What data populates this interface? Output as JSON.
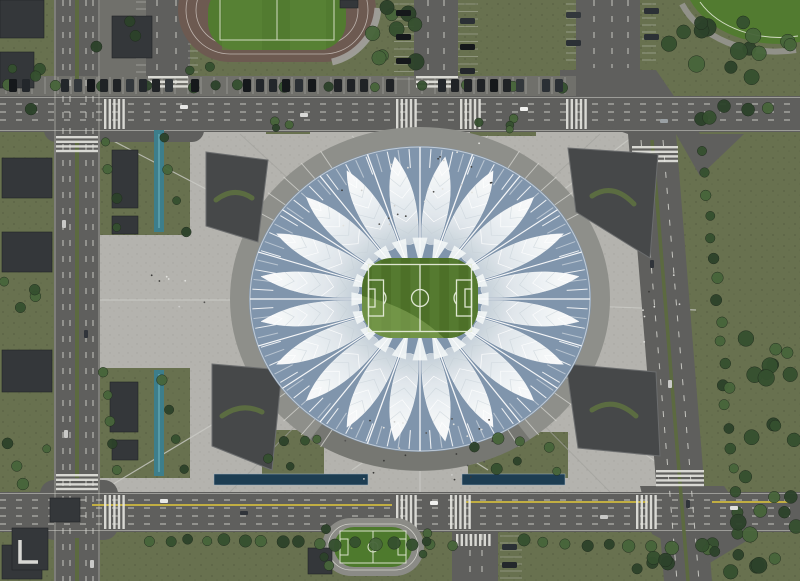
{
  "scene": {
    "kind": "aerial-architectural-rendering",
    "subject": "lotus-flower stadium with central football pitch, surrounding plaza, perimeter roads, sports fields, canals and tree-lined streets"
  },
  "palette": {
    "grass": "#68714f",
    "grass_speck_a": "#49513a",
    "grass_speck_b": "#566043",
    "tree_a": "#35502f",
    "tree_b": "#47653a",
    "tree_c": "#2c422a",
    "plaza": "#b4b3ae",
    "plaza_speck_a": "#97968f",
    "plaza_speck_b": "#a39f97",
    "plaza_line_light": "#cbcbc6",
    "plaza_line_dark": "#a2a29d",
    "asphalt": "#5f5f5d",
    "asphalt_light": "#70706b",
    "lane_white": "#d6d6d0",
    "lane_edge": "#cfcfc9",
    "lane_yellow": "#cfb93f",
    "median_green": "#5c6a40",
    "water_teal": "#3d7e8b",
    "water_teal_light": "#6fb3bd",
    "water_dark": "#1d3d52",
    "water_edge": "#9fb4c2",
    "building": "#34373a",
    "building_edge": "#222426",
    "building_mark": "#d8d8d4",
    "sunken": "#464849",
    "sunken_edge": "#6b6d6e",
    "sunken_green": "#5d7040",
    "podium": "#8e8f8a",
    "podium_shadow": "#6e6f6a",
    "ramp_line": "#d8d8d3",
    "gap_blue": "#8095ac",
    "petal_white": "#ffffff",
    "petal_shade": "#c4ced6",
    "spike_white": "#f0f4f6",
    "pitch_a": "#4d7028",
    "pitch_b": "#557a30",
    "pitch_light": "#8aac5b",
    "pitch_line": "#e6ecda",
    "track_surface": "#6d5a51",
    "track_line": "#cbc3bd",
    "field_green": "#527b30",
    "field_line": "#dfe6d2",
    "mini_track": "#8b8b86",
    "gray_path": "#a3a29d",
    "crowd_dark": "#3a3a38",
    "crowd_light": "#e2e2de",
    "car_dark": "#202326",
    "car_light": "#e8e8e6"
  },
  "stadium": {
    "petal_count": 20,
    "rim_line_count": 96,
    "inner_spike_count": 20,
    "center_x": 420,
    "center_y": 299,
    "radius_x": 170,
    "radius_y": 152
  }
}
